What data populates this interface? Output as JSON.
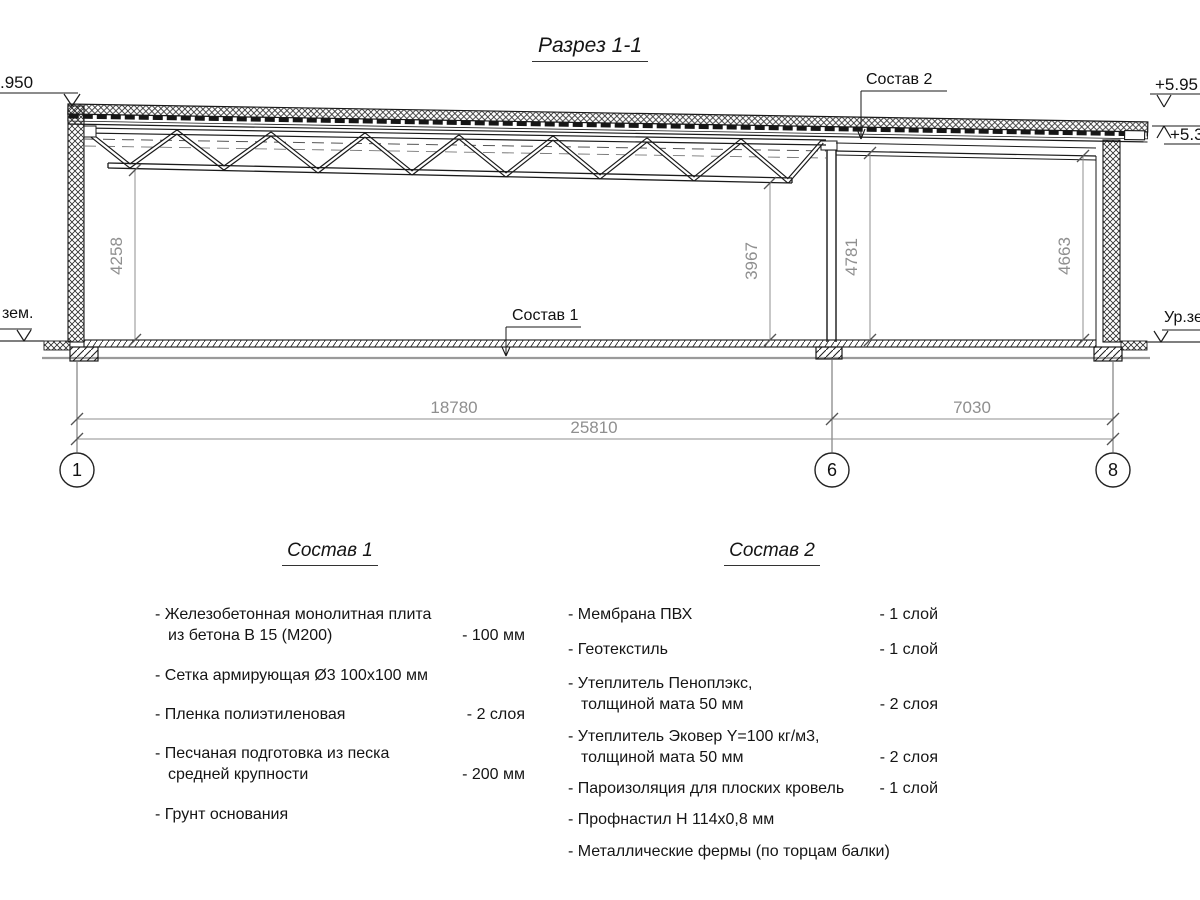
{
  "title": "Разрез 1-1",
  "colors": {
    "line": "#1a1a1a",
    "dim": "#8f8f8f"
  },
  "drawing": {
    "sostav1_label": "Состав 1",
    "sostav2_label": "Состав 2",
    "elev_left": ".950",
    "elev_right_top": "+5.95",
    "elev_right_mid": "+5.38",
    "ground_left": "зем.",
    "ground_right": "Ур.зе",
    "dim_v1": "4258",
    "dim_v2": "3967",
    "dim_v3": "4781",
    "dim_v4": "4663",
    "dim_span1": "18780",
    "dim_span2": "7030",
    "dim_total": "25810",
    "axis1": "1",
    "axis2": "6",
    "axis3": "8"
  },
  "sostav1": {
    "heading": "Состав 1",
    "items": [
      {
        "line1": "- Железобетонная  монолитная плита",
        "line2": "из бетона В 15 (М200)",
        "value": "- 100 мм"
      },
      {
        "line1": "- Сетка армирующая Ø3 100х100 мм",
        "line2": "",
        "value": ""
      },
      {
        "line1": "- Пленка полиэтиленовая",
        "line2": "",
        "value": "-  2 слоя"
      },
      {
        "line1": "- Песчаная подготовка из песка",
        "line2": "средней крупности",
        "value": "- 200 мм"
      },
      {
        "line1": "- Грунт основания",
        "line2": "",
        "value": ""
      }
    ]
  },
  "sostav2": {
    "heading": "Состав 2",
    "items": [
      {
        "line1": "- Мембрана ПВХ",
        "line2": "",
        "value": "- 1 слой"
      },
      {
        "line1": "- Геотекстиль",
        "line2": "",
        "value": "- 1 слой"
      },
      {
        "line1": "- Утеплитель Пеноплэкс,",
        "line2": "толщиной мата 50 мм",
        "value": "- 2 слоя"
      },
      {
        "line1": "- Утеплитель Эковер Y=100 кг/м3,",
        "line2": "толщиной мата 50 мм",
        "value": "- 2 слоя"
      },
      {
        "line1": "- Пароизоляция для плоских кровель",
        "line2": "",
        "value": "- 1 слой"
      },
      {
        "line1": "- Профнастил Н 114х0,8 мм",
        "line2": "",
        "value": ""
      },
      {
        "line1": "- Металлические фермы (по торцам балки)",
        "line2": "",
        "value": ""
      }
    ]
  }
}
